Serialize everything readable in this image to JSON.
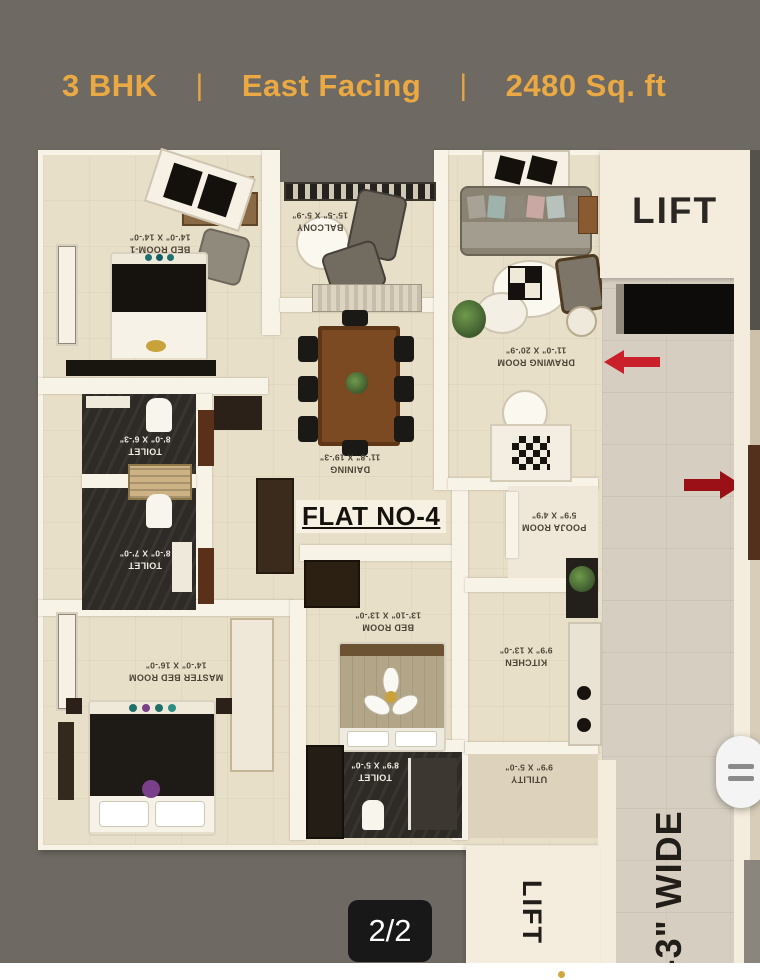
{
  "header": {
    "bhk": "3 BHK",
    "separator": "|",
    "facing": "East Facing",
    "area": "2480 Sq. ft"
  },
  "plan": {
    "flat_no": "FLAT NO-4",
    "lift_label_top": "LIFT",
    "lift_label_bottom": "LIFT",
    "corridor_label": "6'-3\" WIDE",
    "rooms": {
      "bed1": {
        "name": "BED ROOM-1",
        "dims": "14'-0\" X 14'-0\""
      },
      "balcony": {
        "name": "BALCONY",
        "dims": "15'-5\" X 5'-9\""
      },
      "drawing": {
        "name": "DRAWING ROOM",
        "dims": "11'-0\" X 20'-9\""
      },
      "daining": {
        "name": "DAINING",
        "dims": "11'-8\" X 19'-3\""
      },
      "toilet1": {
        "name": "TOILET",
        "dims": "8'-0\" X 6'-3\""
      },
      "toilet2": {
        "name": "TOILET",
        "dims": "8'-0\" X 7'-0\""
      },
      "master": {
        "name": "MASTER BED ROOM",
        "dims": "14'-0\" X 16'-0\""
      },
      "bedroom": {
        "name": "BED ROOM",
        "dims": "13'-10\" X 13'-0\""
      },
      "pooja": {
        "name": "POOJA ROOM",
        "dims": "5'9\" X 4'9\""
      },
      "kitchen": {
        "name": "KITCHEN",
        "dims": "9'9\" X 13'-0\""
      },
      "toilet3": {
        "name": "TOILET",
        "dims": "8'9\" X 5'-0\""
      },
      "utility": {
        "name": "UTILITY",
        "dims": "9'9\" X 5'-0\""
      }
    }
  },
  "viewer": {
    "page_indicator": "2/2"
  },
  "colors": {
    "background": "#6E6A63",
    "accent_gold": "#EBA943",
    "arrow_red": "#C9202B",
    "arrow_dark_red": "#9B1016",
    "badge_bg": "#161616",
    "plan_cream": "#F4EDDD"
  }
}
